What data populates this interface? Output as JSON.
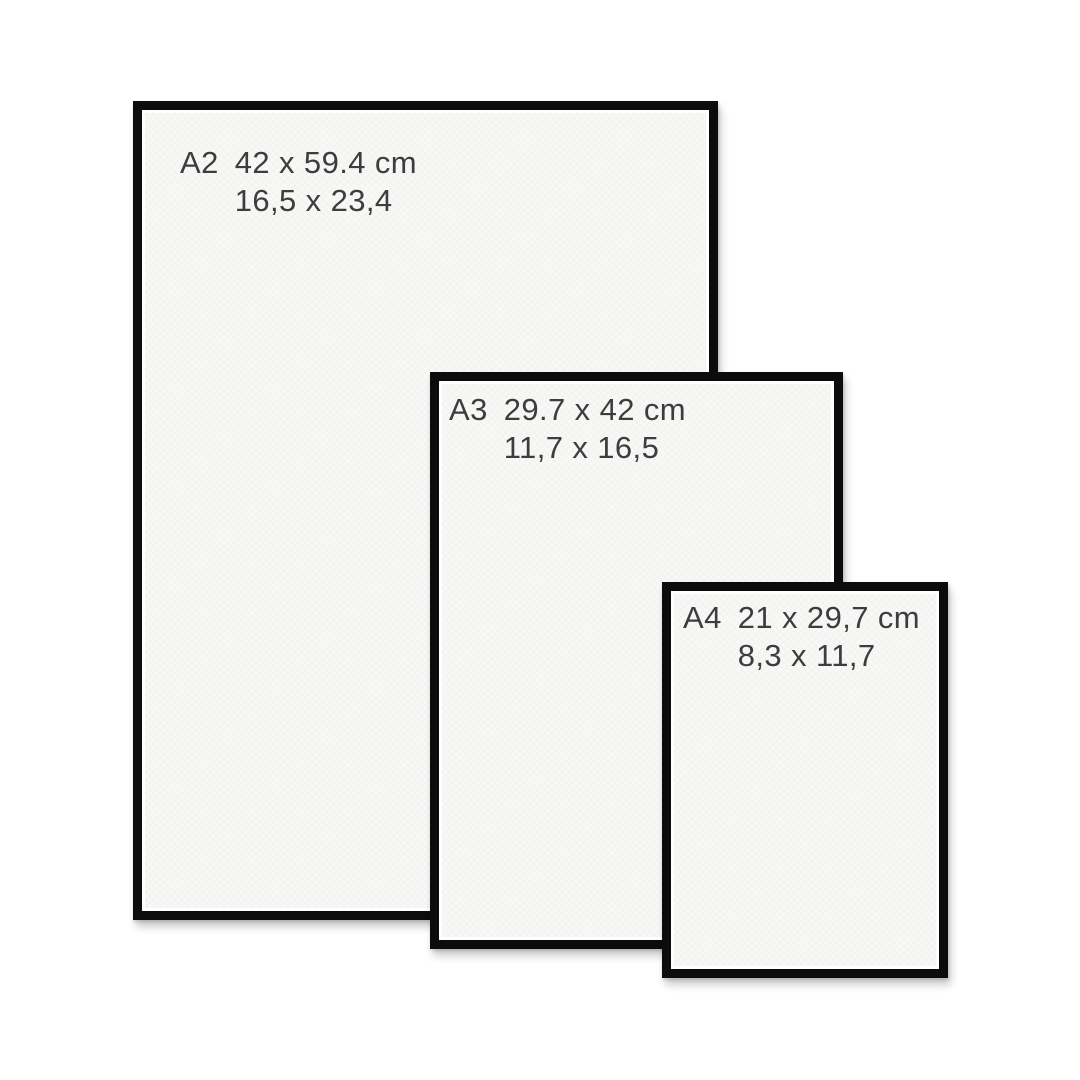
{
  "frames": [
    {
      "code": "A2",
      "cm": "42 x 59.4 cm",
      "inches": "16,5 x 23,4"
    },
    {
      "code": "A3",
      "cm": "29.7 x 42 cm",
      "inches": "11,7 x 16,5"
    },
    {
      "code": "A4",
      "cm": "21 x 29,7 cm",
      "inches": "8,3 x 11,7"
    }
  ],
  "colors": {
    "background": "#ffffff",
    "frame_border": "#0c0c0c",
    "paper": "#f8f8f7",
    "text": "#3d3d3d"
  }
}
